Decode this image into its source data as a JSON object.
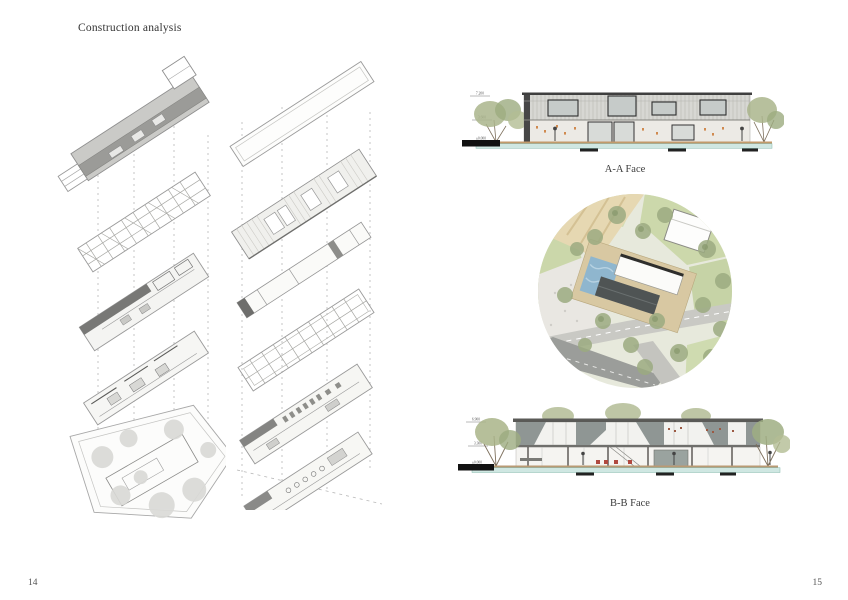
{
  "page": {
    "title": "Construction analysis",
    "left_page_number": "14",
    "right_page_number": "15"
  },
  "elevation_aa": {
    "label": "A-A Face",
    "levels": {
      "top": "7.200",
      "mid": "3.600",
      "base": "±0.000"
    }
  },
  "section_bb": {
    "label": "B-B Face",
    "levels": {
      "top": "6.900",
      "mid": "3.300",
      "base": "±0.000"
    }
  },
  "colors": {
    "tree_green": "#a3b287",
    "lawn_green": "#ccd8ab",
    "water_teal": "#cfe7e2",
    "pool_blue": "#8fb6ce",
    "ground_tan": "#c29a6b",
    "court_tan": "#d8c8a2",
    "road_gray": "#c9c9c4",
    "roof_dark": "#4f5454",
    "line_gray": "#9a9a9a"
  }
}
